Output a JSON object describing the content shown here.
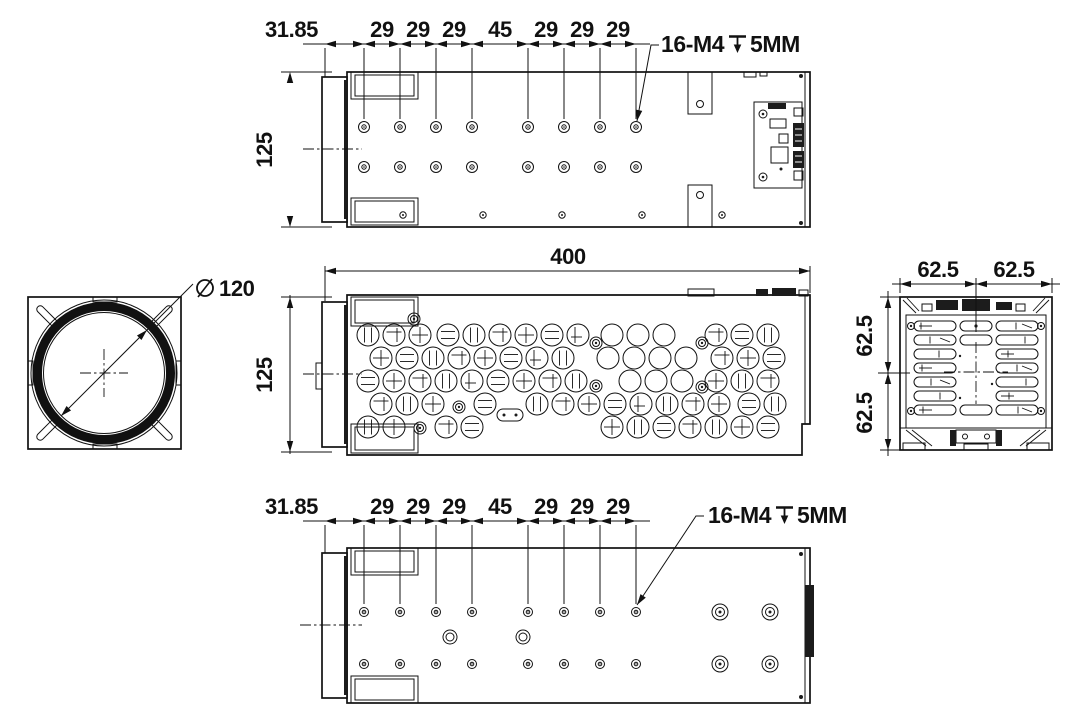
{
  "colors": {
    "background": "#ffffff",
    "line": "#111111"
  },
  "views": {
    "top": {
      "dim_chain": [
        "31.85",
        "29",
        "29",
        "29",
        "45",
        "29",
        "29",
        "29"
      ],
      "height": "125",
      "callout": {
        "prefix": "16-M4",
        "depth_icon": "depth-symbol",
        "suffix": "5MM"
      }
    },
    "front": {
      "diameter": {
        "icon": "diameter-symbol",
        "value": "120"
      }
    },
    "side": {
      "length": "400",
      "height": "125"
    },
    "rear": {
      "width_dims": [
        "62.5",
        "62.5"
      ],
      "height_dims": [
        "62.5",
        "62.5"
      ]
    },
    "bottom": {
      "dim_chain": [
        "31.85",
        "29",
        "29",
        "29",
        "45",
        "29",
        "29",
        "29"
      ],
      "callout": {
        "prefix": "16-M4",
        "depth_icon": "depth-symbol",
        "suffix": "5MM"
      }
    }
  }
}
